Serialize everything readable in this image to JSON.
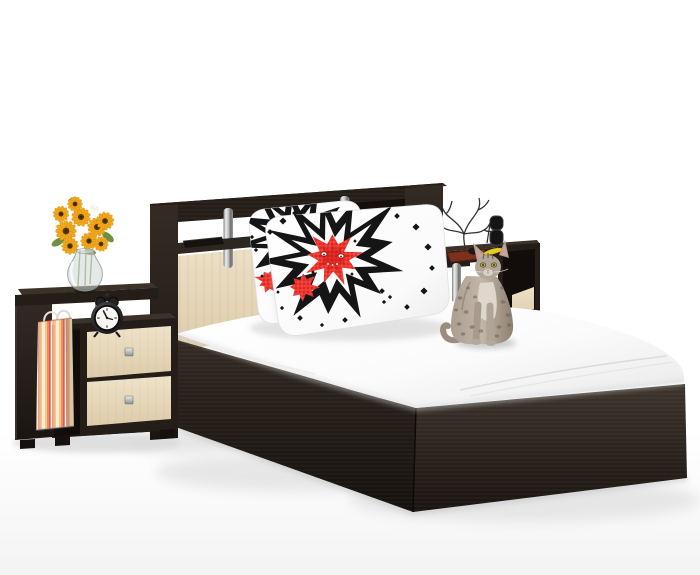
{
  "image_size": {
    "width": 700,
    "height": 575
  },
  "scene": {
    "kind": "furniture-product-photo",
    "description": "Bedroom furniture set on a white studio background: a double bed with dark wenge frame, headboard with open shelves, chrome posts and milk-oak panel, white mattress with two white pillows printed with black comic starbursts and red cross-stitch flowers. Left nightstand with two milk-oak drawers holds a sunflower bouquet in a glass vase, a black twin-bell alarm clock and a striped gift bag. Right nightstand holds a jewelry tree, sunglasses, a phone, a red-brown tray and a banana. A spotted gray cat sits on the edge of the mattress.",
    "objects": [
      {
        "name": "bed-frame",
        "material": "wenge"
      },
      {
        "name": "headboard",
        "material": "wenge, milk oak, chrome"
      },
      {
        "name": "mattress",
        "color_key": "mattress_white"
      },
      {
        "name": "pillows",
        "count": 2,
        "print": "black starburst, red cross-stitch flower, black diamonds"
      },
      {
        "name": "left-nightstand",
        "drawers": 2
      },
      {
        "name": "right-nightstand",
        "drawers": 0
      },
      {
        "name": "sunflower-bouquet"
      },
      {
        "name": "glass-vase"
      },
      {
        "name": "alarm-clock"
      },
      {
        "name": "striped-gift-bag"
      },
      {
        "name": "jewelry-tree"
      },
      {
        "name": "sunglasses"
      },
      {
        "name": "phone"
      },
      {
        "name": "tray"
      },
      {
        "name": "banana"
      },
      {
        "name": "remote-on-headboard-shelf"
      },
      {
        "name": "cat",
        "look": "gray spotted shorthair"
      }
    ]
  },
  "colors": {
    "background_top": "#ffffff",
    "background_bottom": "#f4f4f4",
    "wenge_dark": "#241d18",
    "wenge_mid": "#2e2620",
    "wenge_light": "#3b322a",
    "wenge_interior": "#120d0a",
    "oak_cream": "#eee2c9",
    "oak_cream_dark": "#ddccab",
    "mattress_white": "#ffffff",
    "mattress_shade": "#e8e8e8",
    "chrome_light": "#efefef",
    "chrome_dark": "#7e7e7e",
    "pillow_black": "#151515",
    "pillow_red": "#e8241c",
    "pillow_red_dark": "#c81410",
    "sunflower_yellow": "#f2a71b",
    "sunflower_deep": "#e08a10",
    "sunflower_center": "#54390f",
    "leaf_green": "#6d8f3e",
    "stem_green": "#7a9a55",
    "filler_white": "#f4f3ec",
    "bag_cream": "#f9ecd2",
    "bag_orange": "#f5c98a",
    "bag_deep_orange": "#ef8d62",
    "bag_red": "#e85a4f",
    "bag_pink": "#f2a9a0",
    "clock_black": "#1c1c1c",
    "clock_face": "#f7f6f2",
    "tray_red": "#7e2f1d",
    "banana_yellow": "#e3cd1e",
    "tree_dark": "#35312c",
    "cat_fur": "#ab9e90",
    "cat_fur_light": "#c2b6a8",
    "cat_spot": "#6b5f52",
    "cat_chest": "#ded7cc",
    "cat_eye": "#b5a93f",
    "glass_tint": "#cdd6d4",
    "shadow_soft": "#e0e0e0",
    "shadow_deep": "#bdbdbd"
  }
}
